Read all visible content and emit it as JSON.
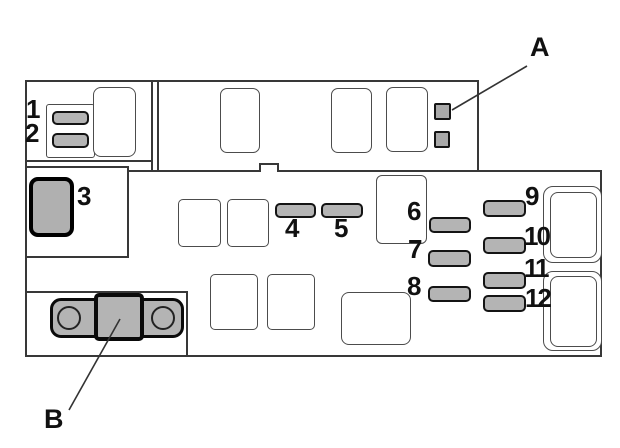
{
  "diagram": {
    "kind": "fuse-box-layout",
    "callouts": {
      "a": "A",
      "b": "B"
    },
    "fuse_numbers": {
      "n1": "1",
      "n2": "2",
      "n3": "3",
      "n4": "4",
      "n5": "5",
      "n6": "6",
      "n7": "7",
      "n8": "8",
      "n9": "9",
      "n10": "10",
      "n11": "11",
      "n12": "12"
    }
  },
  "colors": {
    "background": "#ffffff",
    "panel_outline": "#383838",
    "slot_outline": "#4c4c4c",
    "fuse_fill": "#b4b4b4",
    "fuse_border": "#141414",
    "component_fill": "#b0b0b0",
    "label_text": "#111111"
  }
}
